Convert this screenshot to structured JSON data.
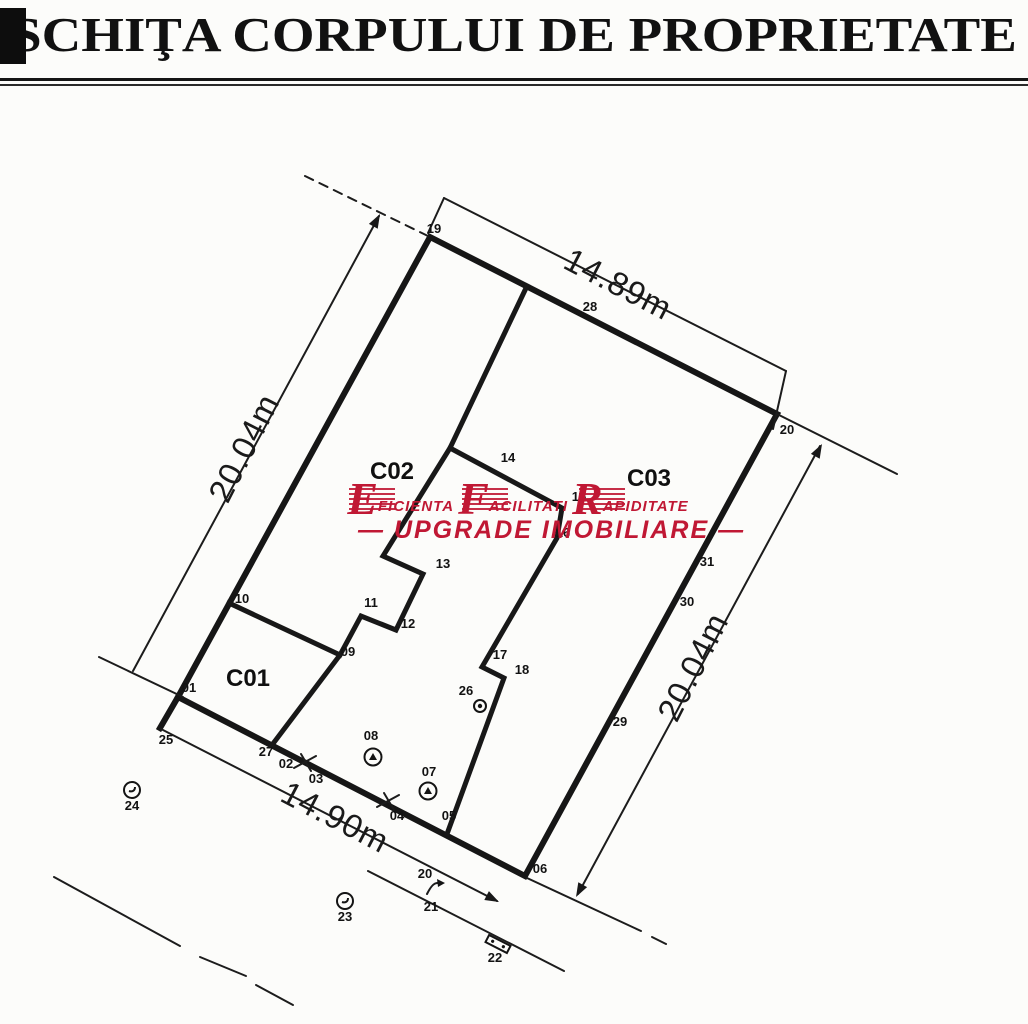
{
  "page": {
    "title": "SCHIŢA CORPULUI DE PROPRIETATE"
  },
  "watermark": {
    "color": "#c01834",
    "words": [
      {
        "big": "E",
        "rest": "FICIENTA"
      },
      {
        "big": "F",
        "rest": "ACILITATI"
      },
      {
        "big": "R",
        "rest": "APIDITATE"
      }
    ],
    "tagline": "— UPGRADE  IMOBILIARE —"
  },
  "plan": {
    "building_labels": [
      {
        "id": "C01",
        "label": "C01",
        "x": 248,
        "y": 686
      },
      {
        "id": "C02",
        "label": "C02",
        "x": 392,
        "y": 479
      },
      {
        "id": "C03",
        "label": "C03",
        "x": 649,
        "y": 486
      }
    ],
    "dimensions": [
      {
        "id": "top",
        "label": "14.89m",
        "x": 613,
        "y": 294,
        "rot": 27.5
      },
      {
        "id": "left",
        "label": "20.04m",
        "x": 254,
        "y": 453,
        "rot": -63
      },
      {
        "id": "right",
        "label": "20.04m",
        "x": 703,
        "y": 672,
        "rot": -63
      },
      {
        "id": "bottom",
        "label": "14.90m",
        "x": 330,
        "y": 827,
        "rot": 27.5
      }
    ],
    "points": [
      {
        "n": "19",
        "x": 434,
        "y": 229
      },
      {
        "n": "28",
        "x": 590,
        "y": 307
      },
      {
        "n": "20",
        "x": 787,
        "y": 430
      },
      {
        "n": "31",
        "x": 707,
        "y": 562
      },
      {
        "n": "30",
        "x": 687,
        "y": 602
      },
      {
        "n": "29",
        "x": 620,
        "y": 722
      },
      {
        "n": "06",
        "x": 540,
        "y": 869
      },
      {
        "n": "05",
        "x": 449,
        "y": 816
      },
      {
        "n": "04",
        "x": 397,
        "y": 816
      },
      {
        "n": "03",
        "x": 316,
        "y": 779
      },
      {
        "n": "02",
        "x": 286,
        "y": 764
      },
      {
        "n": "27",
        "x": 266,
        "y": 752
      },
      {
        "n": "01",
        "x": 189,
        "y": 688
      },
      {
        "n": "25",
        "x": 166,
        "y": 740
      },
      {
        "n": "10",
        "x": 242,
        "y": 599
      },
      {
        "n": "13",
        "x": 443,
        "y": 564
      },
      {
        "n": "11",
        "x": 371,
        "y": 603
      },
      {
        "n": "12",
        "x": 408,
        "y": 624
      },
      {
        "n": "09",
        "x": 348,
        "y": 652
      },
      {
        "n": "14",
        "x": 508,
        "y": 458
      },
      {
        "n": "15",
        "x": 579,
        "y": 497
      },
      {
        "n": "16",
        "x": 563,
        "y": 533
      },
      {
        "n": "17",
        "x": 500,
        "y": 655
      },
      {
        "n": "18",
        "x": 522,
        "y": 670
      },
      {
        "n": "26",
        "x": 466,
        "y": 691
      },
      {
        "n": "08",
        "x": 371,
        "y": 736
      },
      {
        "n": "07",
        "x": 429,
        "y": 772
      },
      {
        "n": "20",
        "x": 425,
        "y": 874
      },
      {
        "n": "21",
        "x": 431,
        "y": 907
      },
      {
        "n": "22",
        "x": 495,
        "y": 958
      },
      {
        "n": "23",
        "x": 345,
        "y": 917
      },
      {
        "n": "24",
        "x": 132,
        "y": 806
      }
    ],
    "symbols": [
      {
        "name": "circled-hook-symbol-24",
        "type": "circle-hook",
        "x": 132,
        "y": 790,
        "rot": 0
      },
      {
        "name": "circled-hook-symbol-23",
        "type": "circle-hook",
        "x": 345,
        "y": 901,
        "rot": 0
      },
      {
        "name": "circled-triangle-symbol-08",
        "type": "circle-triangle",
        "x": 373,
        "y": 757,
        "rot": 0
      },
      {
        "name": "circled-triangle-symbol-07",
        "type": "circle-triangle",
        "x": 428,
        "y": 791,
        "rot": 0
      },
      {
        "name": "circled-plus-symbol-26",
        "type": "circle-plus",
        "x": 480,
        "y": 706,
        "rot": 0
      },
      {
        "name": "gate-mark-a",
        "type": "cross-tick",
        "x": 305,
        "y": 762,
        "rot": 0
      },
      {
        "name": "gate-mark-b",
        "type": "cross-tick",
        "x": 388,
        "y": 801,
        "rot": 0
      },
      {
        "name": "tag-rect-symbol-22",
        "type": "tag-rect",
        "x": 498,
        "y": 944,
        "rot": 27
      },
      {
        "name": "hook-arrow-symbol-20",
        "type": "hook-arrow",
        "x": 434,
        "y": 886,
        "rot": 0
      }
    ]
  }
}
